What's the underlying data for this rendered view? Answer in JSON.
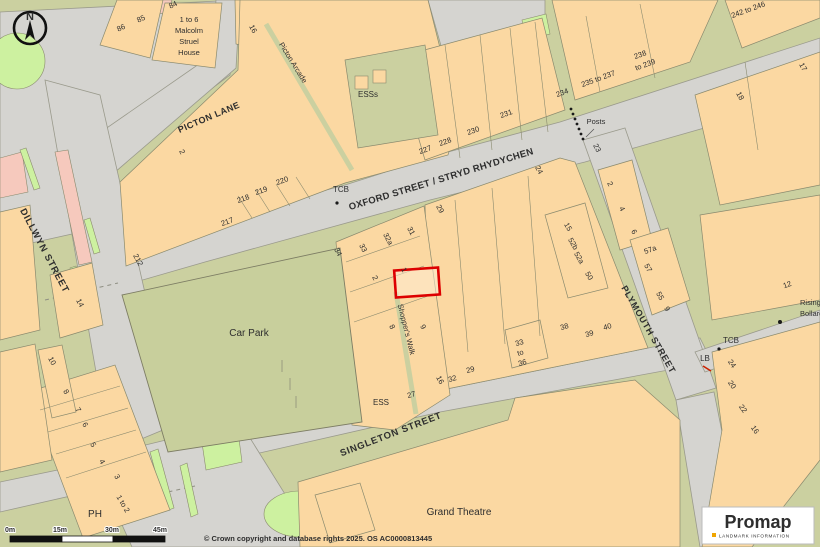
{
  "map": {
    "labels": [
      {
        "name": "street-label-picton-lane",
        "text": "PICTON LANE",
        "x": 210,
        "y": 120,
        "rotate": -23,
        "size": 9,
        "bold": true,
        "spacing": 0.5
      },
      {
        "name": "street-label-oxford-street",
        "text": "OXFORD STREET / STRYD RHYDYCHEN",
        "x": 442,
        "y": 182,
        "rotate": -17,
        "size": 9.5,
        "bold": true,
        "spacing": 0.3
      },
      {
        "name": "street-label-dillwyn-street",
        "text": "DILLWYN STREET",
        "x": 42,
        "y": 252,
        "rotate": 62,
        "size": 9.5,
        "bold": true,
        "spacing": 0.8
      },
      {
        "name": "street-label-singleton-street",
        "text": "SINGLETON STREET",
        "x": 392,
        "y": 437,
        "rotate": -21,
        "size": 9.5,
        "bold": true,
        "spacing": 0.8
      },
      {
        "name": "street-label-plymouth-street",
        "text": "PLYMOUTH   STREET",
        "x": 646,
        "y": 331,
        "rotate": 60,
        "size": 9,
        "bold": true,
        "spacing": 0.8
      },
      {
        "name": "walk-label-shoppers-walk",
        "text": "Shopper's Walk",
        "x": 404,
        "y": 330,
        "rotate": 76,
        "size": 7.5
      },
      {
        "name": "arcade-label-picton-arcade",
        "text": "Picton  Arcade",
        "x": 291,
        "y": 64,
        "rotate": 58,
        "size": 7.5
      },
      {
        "name": "area-label-car-park",
        "text": "Car Park",
        "x": 249,
        "y": 336,
        "size": 10
      },
      {
        "name": "area-label-grand-theatre",
        "text": "Grand Theatre",
        "x": 459,
        "y": 515,
        "size": 10
      },
      {
        "name": "building-label-malcolm-line1",
        "text": "1 to 6",
        "x": 189,
        "y": 22,
        "size": 7.5
      },
      {
        "name": "building-label-malcolm-line2",
        "text": "Malcolm",
        "x": 189,
        "y": 33,
        "size": 7.5
      },
      {
        "name": "building-label-malcolm-line3",
        "text": "Struel",
        "x": 189,
        "y": 44,
        "size": 7.5
      },
      {
        "name": "building-label-malcolm-line4",
        "text": "House",
        "x": 189,
        "y": 55,
        "size": 7.5
      },
      {
        "name": "poi-label-esss",
        "text": "ESSs",
        "x": 368,
        "y": 97,
        "size": 8
      },
      {
        "name": "poi-label-ess",
        "text": "ESS",
        "x": 381,
        "y": 405,
        "size": 8
      },
      {
        "name": "poi-label-posts",
        "text": "Posts",
        "x": 596,
        "y": 124,
        "size": 7.5
      },
      {
        "name": "poi-label-tcb-north",
        "text": "TCB",
        "x": 341,
        "y": 192,
        "size": 8
      },
      {
        "name": "poi-label-tcb-south",
        "text": "TCB",
        "x": 731,
        "y": 343,
        "size": 8
      },
      {
        "name": "poi-label-lb",
        "text": "LB",
        "x": 705,
        "y": 361,
        "size": 8
      },
      {
        "name": "poi-label-ph",
        "text": "PH",
        "x": 95,
        "y": 517,
        "size": 10
      },
      {
        "name": "poi-label-rising",
        "text": "Rising",
        "x": 800,
        "y": 305,
        "size": 7.5,
        "anchor": "start"
      },
      {
        "name": "poi-label-bollards",
        "text": "Bollards",
        "x": 800,
        "y": 316,
        "size": 7.5,
        "anchor": "start"
      },
      {
        "name": "number-33to36-a",
        "text": "33",
        "x": 520,
        "y": 345,
        "size": 7.5,
        "rotate": -15
      },
      {
        "name": "number-33to36-b",
        "text": "to",
        "x": 521,
        "y": 355,
        "size": 7.5,
        "rotate": -15
      },
      {
        "name": "number-33to36-c",
        "text": "36",
        "x": 523,
        "y": 365,
        "size": 7.5,
        "rotate": -15
      },
      {
        "name": "number-86",
        "text": "86",
        "x": 122,
        "y": 30,
        "rotate": -25,
        "size": 7.5
      },
      {
        "name": "number-85",
        "text": "85",
        "x": 142,
        "y": 21,
        "rotate": -25,
        "size": 7.5
      },
      {
        "name": "number-84",
        "text": "84",
        "x": 174,
        "y": 7,
        "rotate": -25,
        "size": 7.5
      },
      {
        "name": "number-16-top",
        "text": "16",
        "x": 251,
        "y": 30,
        "rotate": 62,
        "size": 7.5
      },
      {
        "name": "number-2-west",
        "text": "2",
        "x": 180,
        "y": 153,
        "rotate": 62,
        "size": 7.5
      },
      {
        "name": "number-212",
        "text": "212",
        "x": 136,
        "y": 261,
        "rotate": 62,
        "size": 7.5
      },
      {
        "name": "number-217",
        "text": "217",
        "x": 228,
        "y": 224,
        "rotate": -20,
        "size": 7.5
      },
      {
        "name": "number-218",
        "text": "218",
        "x": 244,
        "y": 201,
        "rotate": -20,
        "size": 7.5
      },
      {
        "name": "number-219",
        "text": "219",
        "x": 262,
        "y": 193,
        "rotate": -20,
        "size": 7.5
      },
      {
        "name": "number-220",
        "text": "220",
        "x": 283,
        "y": 183,
        "rotate": -20,
        "size": 7.5
      },
      {
        "name": "number-227",
        "text": "227",
        "x": 426,
        "y": 152,
        "rotate": -20,
        "size": 7.5
      },
      {
        "name": "number-228",
        "text": "228",
        "x": 446,
        "y": 144,
        "rotate": -20,
        "size": 7.5
      },
      {
        "name": "number-230",
        "text": "230",
        "x": 474,
        "y": 133,
        "rotate": -20,
        "size": 7.5
      },
      {
        "name": "number-231",
        "text": "231",
        "x": 507,
        "y": 116,
        "rotate": -20,
        "size": 7.5
      },
      {
        "name": "number-234",
        "text": "234",
        "x": 563,
        "y": 95,
        "rotate": -20,
        "size": 7.5
      },
      {
        "name": "number-235to237",
        "text": "235 to 237",
        "x": 599,
        "y": 81,
        "rotate": -20,
        "size": 7.5
      },
      {
        "name": "number-238",
        "text": "238",
        "x": 641,
        "y": 57,
        "rotate": -20,
        "size": 7.5
      },
      {
        "name": "number-to239",
        "text": "to 239",
        "x": 646,
        "y": 67,
        "rotate": -20,
        "size": 7.5
      },
      {
        "name": "number-242to246",
        "text": "242 to 246",
        "x": 749,
        "y": 12,
        "rotate": -20,
        "size": 7.5
      },
      {
        "name": "number-17",
        "text": "17",
        "x": 801,
        "y": 68,
        "rotate": 62,
        "size": 7.5
      },
      {
        "name": "number-18",
        "text": "18",
        "x": 738,
        "y": 97,
        "rotate": 62,
        "size": 7.5
      },
      {
        "name": "number-23",
        "text": "23",
        "x": 595,
        "y": 149,
        "rotate": 62,
        "size": 7.5
      },
      {
        "name": "number-24-oxford",
        "text": "24",
        "x": 537,
        "y": 171,
        "rotate": 62,
        "size": 7.5
      },
      {
        "name": "number-2-plymouth",
        "text": "2",
        "x": 608,
        "y": 185,
        "rotate": 62,
        "size": 7.5
      },
      {
        "name": "number-4-plymouth",
        "text": "4",
        "x": 620,
        "y": 210,
        "rotate": 62,
        "size": 7.5
      },
      {
        "name": "number-6-plymouth",
        "text": "6",
        "x": 632,
        "y": 233,
        "rotate": 62,
        "size": 7.5
      },
      {
        "name": "number-57a",
        "text": "57a",
        "x": 651,
        "y": 252,
        "rotate": -20,
        "size": 7.5
      },
      {
        "name": "number-57",
        "text": "57",
        "x": 646,
        "y": 269,
        "rotate": 62,
        "size": 7.5
      },
      {
        "name": "number-55",
        "text": "55",
        "x": 658,
        "y": 297,
        "rotate": 62,
        "size": 7.5
      },
      {
        "name": "number-9-east",
        "text": "9",
        "x": 665,
        "y": 310,
        "rotate": 62,
        "size": 7.5
      },
      {
        "name": "number-12",
        "text": "12",
        "x": 788,
        "y": 287,
        "rotate": -20,
        "size": 7.5
      },
      {
        "name": "number-29-block",
        "text": "29",
        "x": 438,
        "y": 210,
        "rotate": 62,
        "size": 7.5
      },
      {
        "name": "number-31",
        "text": "31",
        "x": 409,
        "y": 232,
        "rotate": 62,
        "size": 7.5
      },
      {
        "name": "number-32a",
        "text": "32a",
        "x": 386,
        "y": 240,
        "rotate": 62,
        "size": 7.5
      },
      {
        "name": "number-33-walk",
        "text": "33",
        "x": 361,
        "y": 249,
        "rotate": 62,
        "size": 7.5
      },
      {
        "name": "number-34-walk",
        "text": "34",
        "x": 336,
        "y": 253,
        "rotate": 62,
        "size": 7.5
      },
      {
        "name": "number-2-walk",
        "text": "2",
        "x": 373,
        "y": 279,
        "rotate": 62,
        "size": 7.5
      },
      {
        "name": "number-1-plot",
        "text": "1",
        "x": 402,
        "y": 271,
        "rotate": 62,
        "size": 7.5
      },
      {
        "name": "number-8-walk",
        "text": "8",
        "x": 390,
        "y": 328,
        "rotate": 62,
        "size": 7.5
      },
      {
        "name": "number-9-walk",
        "text": "9",
        "x": 421,
        "y": 328,
        "rotate": 62,
        "size": 7.5
      },
      {
        "name": "number-16-walk",
        "text": "16",
        "x": 438,
        "y": 381,
        "rotate": 62,
        "size": 7.5
      },
      {
        "name": "number-32",
        "text": "32",
        "x": 453,
        "y": 381,
        "rotate": -15,
        "size": 7.5
      },
      {
        "name": "number-27",
        "text": "27",
        "x": 412,
        "y": 397,
        "rotate": -15,
        "size": 7.5
      },
      {
        "name": "number-29-singleton",
        "text": "29",
        "x": 471,
        "y": 372,
        "rotate": -15,
        "size": 7.5
      },
      {
        "name": "number-15",
        "text": "15",
        "x": 566,
        "y": 228,
        "rotate": 60,
        "size": 7.5
      },
      {
        "name": "number-52b",
        "text": "52b",
        "x": 571,
        "y": 245,
        "rotate": 60,
        "size": 7.5
      },
      {
        "name": "number-52a",
        "text": "52a",
        "x": 577,
        "y": 259,
        "rotate": 60,
        "size": 7.5
      },
      {
        "name": "number-50",
        "text": "50",
        "x": 587,
        "y": 277,
        "rotate": 60,
        "size": 7.5
      },
      {
        "name": "number-38",
        "text": "38",
        "x": 565,
        "y": 329,
        "rotate": -15,
        "size": 7.5
      },
      {
        "name": "number-39",
        "text": "39",
        "x": 590,
        "y": 336,
        "rotate": -15,
        "size": 7.5
      },
      {
        "name": "number-40",
        "text": "40",
        "x": 608,
        "y": 329,
        "rotate": -15,
        "size": 7.5
      },
      {
        "name": "number-24-se",
        "text": "24",
        "x": 730,
        "y": 365,
        "rotate": 55,
        "size": 7.5
      },
      {
        "name": "number-20-se",
        "text": "20",
        "x": 730,
        "y": 386,
        "rotate": 55,
        "size": 7.5
      },
      {
        "name": "number-22-se",
        "text": "22",
        "x": 741,
        "y": 410,
        "rotate": 55,
        "size": 7.5
      },
      {
        "name": "number-16-se",
        "text": "16",
        "x": 753,
        "y": 431,
        "rotate": 55,
        "size": 7.5
      },
      {
        "name": "number-14",
        "text": "14",
        "x": 78,
        "y": 304,
        "rotate": 62,
        "size": 7.5
      },
      {
        "name": "number-10",
        "text": "10",
        "x": 50,
        "y": 362,
        "rotate": 62,
        "size": 7.5
      },
      {
        "name": "number-8-ph",
        "text": "8",
        "x": 64,
        "y": 393,
        "rotate": 60,
        "size": 7.5
      },
      {
        "name": "number-7-ph",
        "text": "7",
        "x": 76,
        "y": 411,
        "rotate": 60,
        "size": 7.5
      },
      {
        "name": "number-6-ph",
        "text": "6",
        "x": 83,
        "y": 426,
        "rotate": 60,
        "size": 7.5
      },
      {
        "name": "number-5-ph",
        "text": "5",
        "x": 91,
        "y": 446,
        "rotate": 60,
        "size": 7.5
      },
      {
        "name": "number-4-ph",
        "text": "4",
        "x": 100,
        "y": 463,
        "rotate": 60,
        "size": 7.5
      },
      {
        "name": "number-3-ph",
        "text": "3",
        "x": 115,
        "y": 478,
        "rotate": 60,
        "size": 7.5
      },
      {
        "name": "number-1to2-ph",
        "text": "1 to 2",
        "x": 121,
        "y": 505,
        "rotate": 60,
        "size": 7.5
      }
    ]
  },
  "compass": {
    "north": "N"
  },
  "scale_bar": {
    "ticks": [
      "0m",
      "15m",
      "30m",
      "45m"
    ]
  },
  "footer": {
    "copyright": "© Crown copyright and database rights 2025. OS AC0000813445"
  },
  "logo": {
    "brand": "Promap",
    "tagline": "LANDMARK INFORMATION"
  },
  "highlight": {
    "plot_outline_color": "#dd0000"
  },
  "colors": {
    "building": "#fbd8a2",
    "road": "#d5d4d0",
    "verge": "#cbd0a0",
    "green_space": "#cdf1a0",
    "pink_area": "#f6c9bd",
    "outline": "#8a8a6e",
    "label_text": "#2e2e2e",
    "logo_dot": "#f0a500"
  }
}
